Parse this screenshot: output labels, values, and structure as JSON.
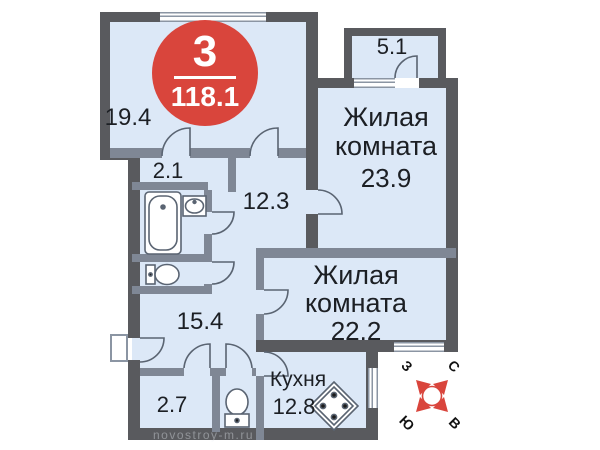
{
  "badge": {
    "number": "3",
    "total_area": "118.1"
  },
  "rooms": {
    "top_room": {
      "area": "19.4"
    },
    "closet": {
      "area": "2.1"
    },
    "hall": {
      "area": "12.3"
    },
    "hallway": {
      "area": "15.4"
    },
    "small_room": {
      "area": "2.7"
    },
    "balcony": {
      "area": "5.1"
    },
    "living1": {
      "line1": "Жилая",
      "line2": "комната",
      "area": "23.9"
    },
    "living2": {
      "line1": "Жилая",
      "line2": "комната",
      "area": "22.2"
    },
    "kitchen": {
      "name": "Кухня",
      "area": "12.8"
    }
  },
  "compass": {
    "north": "С",
    "east": "В",
    "south": "Ю",
    "west": "З"
  },
  "watermark": "novostroy-m.ru",
  "colors": {
    "accent_red": "#d9453c",
    "floor_fill": "#dce8f7",
    "wall_dark": "#595a5e",
    "wall_light": "#7f8795"
  }
}
